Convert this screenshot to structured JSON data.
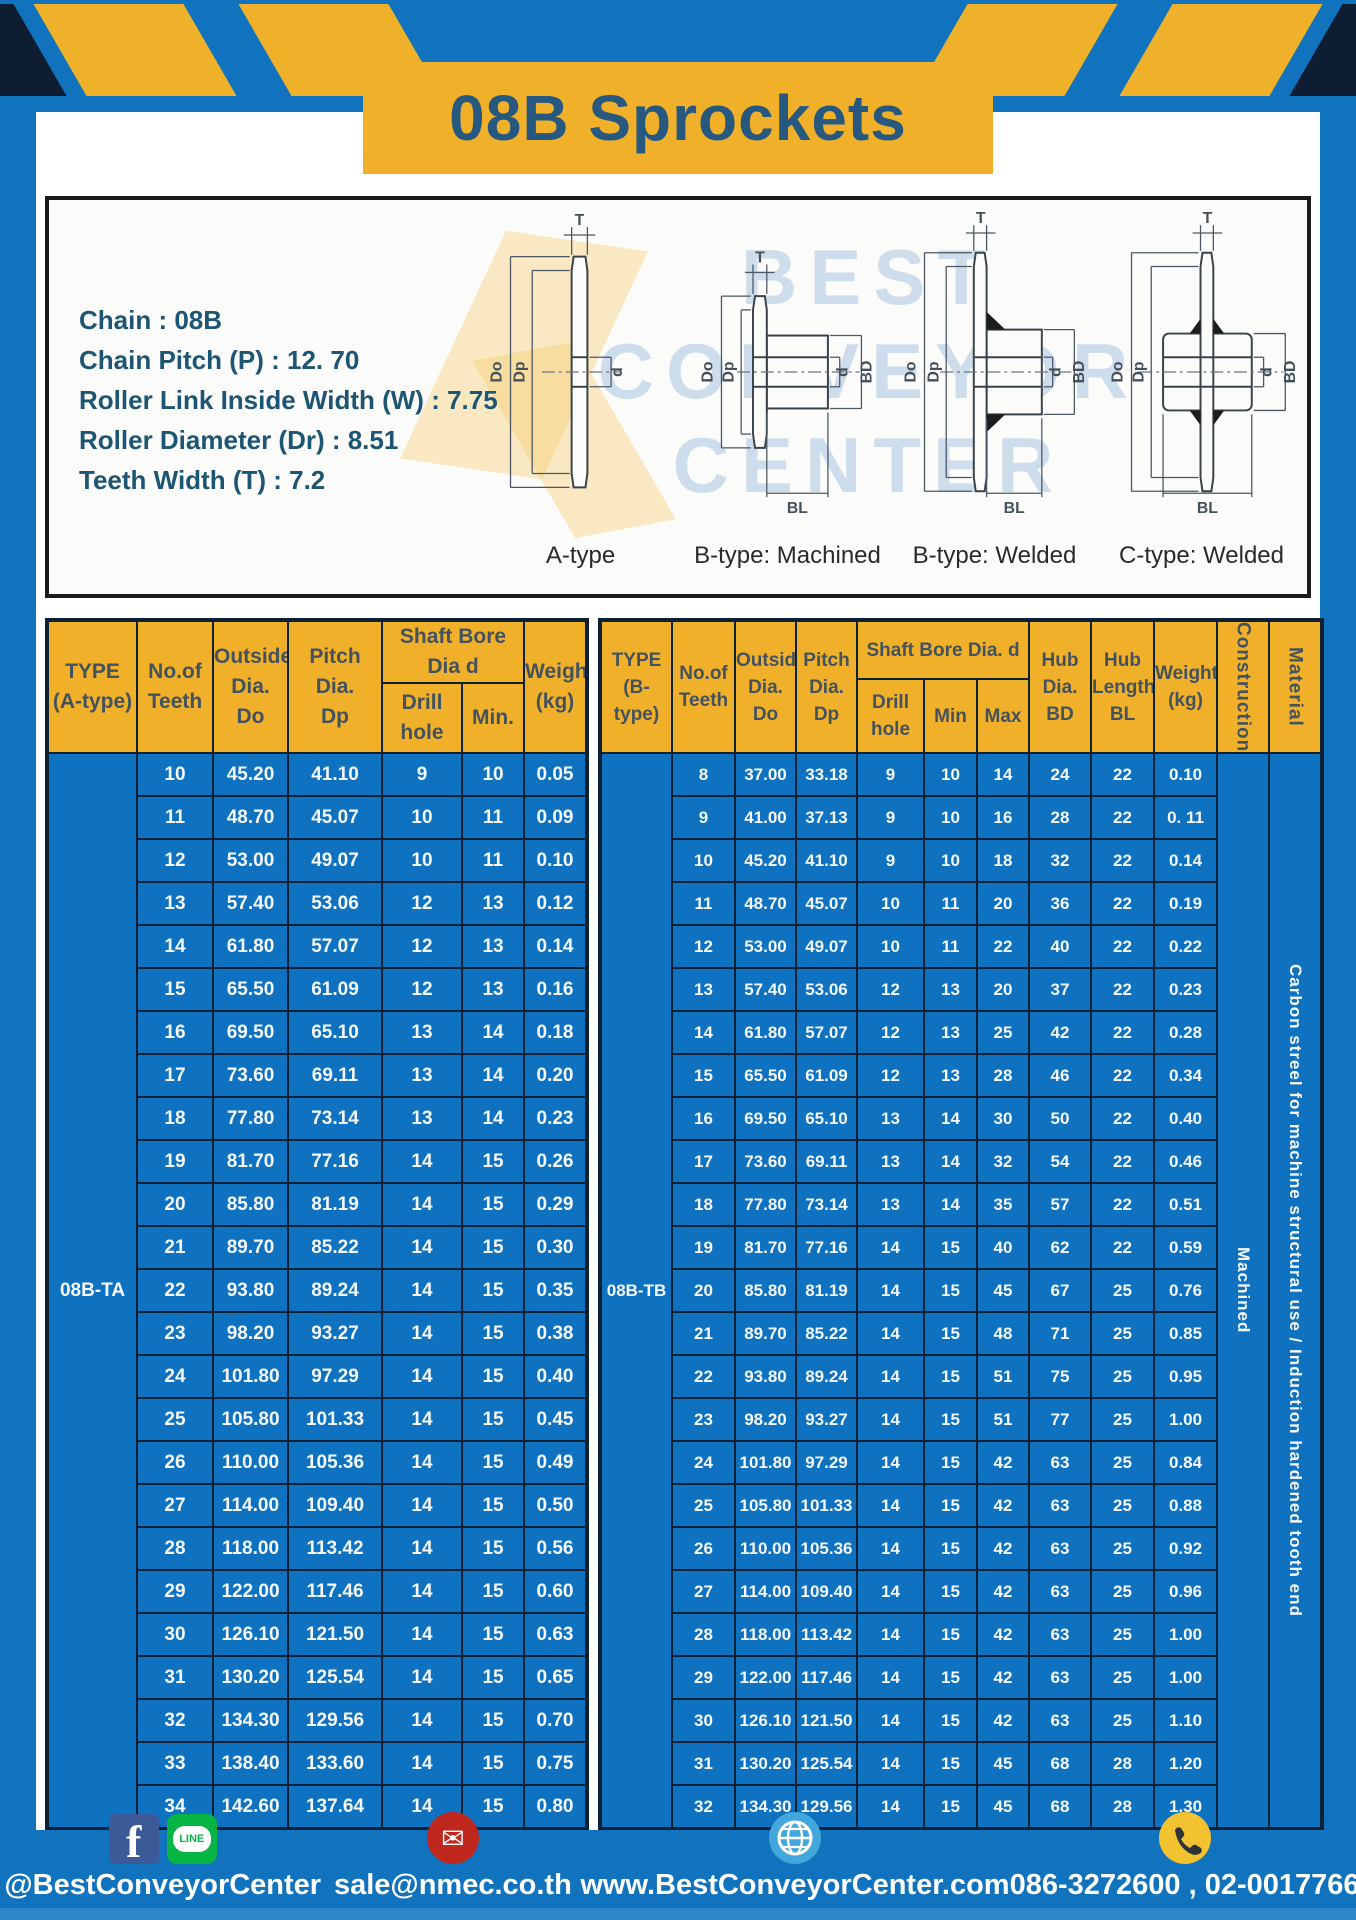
{
  "title": "08B Sprockets",
  "specs": {
    "lines": [
      "Chain  : 08B",
      "Chain Pitch (P)  :  12. 70",
      "Roller Link Inside Width (W)  :  7.75",
      "Roller Diameter (Dr)  : 8.51",
      "Teeth Width (T)  :  7.2"
    ]
  },
  "diagrams": {
    "captions": [
      "A-type",
      "B-type: Machined",
      "B-type: Welded",
      "C-type: Welded"
    ],
    "dims": {
      "t": "T",
      "do": "Do",
      "dp": "Dp",
      "d": "d",
      "bd": "BD",
      "bl": "BL"
    },
    "watermark": [
      "BEST",
      "CONVEYOR",
      "CENTER"
    ]
  },
  "table_a": {
    "type_label": "08B-TA",
    "headers": {
      "type1": "TYPE",
      "type2": "(A-type)",
      "teeth1": "No.of",
      "teeth2": "Teeth",
      "out1": "Outside",
      "out2": "Dia.",
      "out3": "Do",
      "pitch1": "Pitch Dia.",
      "pitch2": "Dp",
      "bore": "Shaft Bore Dia d",
      "drill": "Drill hole",
      "min": "Min.",
      "w1": "Weight",
      "w2": "(kg)"
    },
    "rows": [
      [
        "10",
        "45.20",
        "41.10",
        "9",
        "10",
        "0.05"
      ],
      [
        "11",
        "48.70",
        "45.07",
        "10",
        "11",
        "0.09"
      ],
      [
        "12",
        "53.00",
        "49.07",
        "10",
        "11",
        "0.10"
      ],
      [
        "13",
        "57.40",
        "53.06",
        "12",
        "13",
        "0.12"
      ],
      [
        "14",
        "61.80",
        "57.07",
        "12",
        "13",
        "0.14"
      ],
      [
        "15",
        "65.50",
        "61.09",
        "12",
        "13",
        "0.16"
      ],
      [
        "16",
        "69.50",
        "65.10",
        "13",
        "14",
        "0.18"
      ],
      [
        "17",
        "73.60",
        "69.11",
        "13",
        "14",
        "0.20"
      ],
      [
        "18",
        "77.80",
        "73.14",
        "13",
        "14",
        "0.23"
      ],
      [
        "19",
        "81.70",
        "77.16",
        "14",
        "15",
        "0.26"
      ],
      [
        "20",
        "85.80",
        "81.19",
        "14",
        "15",
        "0.29"
      ],
      [
        "21",
        "89.70",
        "85.22",
        "14",
        "15",
        "0.30"
      ],
      [
        "22",
        "93.80",
        "89.24",
        "14",
        "15",
        "0.35"
      ],
      [
        "23",
        "98.20",
        "93.27",
        "14",
        "15",
        "0.38"
      ],
      [
        "24",
        "101.80",
        "97.29",
        "14",
        "15",
        "0.40"
      ],
      [
        "25",
        "105.80",
        "101.33",
        "14",
        "15",
        "0.45"
      ],
      [
        "26",
        "110.00",
        "105.36",
        "14",
        "15",
        "0.49"
      ],
      [
        "27",
        "114.00",
        "109.40",
        "14",
        "15",
        "0.50"
      ],
      [
        "28",
        "118.00",
        "113.42",
        "14",
        "15",
        "0.56"
      ],
      [
        "29",
        "122.00",
        "117.46",
        "14",
        "15",
        "0.60"
      ],
      [
        "30",
        "126.10",
        "121.50",
        "14",
        "15",
        "0.63"
      ],
      [
        "31",
        "130.20",
        "125.54",
        "14",
        "15",
        "0.65"
      ],
      [
        "32",
        "134.30",
        "129.56",
        "14",
        "15",
        "0.70"
      ],
      [
        "33",
        "138.40",
        "133.60",
        "14",
        "15",
        "0.75"
      ],
      [
        "34",
        "142.60",
        "137.64",
        "14",
        "15",
        "0.80"
      ]
    ]
  },
  "table_b": {
    "type_label": "08B-TB",
    "construction": "Machined",
    "material": "Carbon streel for machine structural use / Induction hardened tooth end",
    "headers": {
      "type1": "TYPE",
      "type2": "(B-type)",
      "teeth1": "No.of",
      "teeth2": "Teeth",
      "out1": "Outside",
      "out2": "Dia.",
      "out3": "Do",
      "pitch1": "Pitch",
      "pitch2": "Dia.",
      "pitch3": "Dp",
      "bore": "Shaft Bore Dia.  d",
      "drill": "Drill hole",
      "min": "Min",
      "max": "Max",
      "hub1": "Hub",
      "hub2": "Dia.",
      "hub3": "BD",
      "hubl1": "Hub",
      "hubl2": "Length",
      "hubl3": "BL",
      "w1": "Weight",
      "w2": "(kg)",
      "construction": "Construction",
      "material": "Material"
    },
    "rows": [
      [
        "8",
        "37.00",
        "33.18",
        "9",
        "10",
        "14",
        "24",
        "22",
        "0.10"
      ],
      [
        "9",
        "41.00",
        "37.13",
        "9",
        "10",
        "16",
        "28",
        "22",
        "0. 11"
      ],
      [
        "10",
        "45.20",
        "41.10",
        "9",
        "10",
        "18",
        "32",
        "22",
        "0.14"
      ],
      [
        "11",
        "48.70",
        "45.07",
        "10",
        "11",
        "20",
        "36",
        "22",
        "0.19"
      ],
      [
        "12",
        "53.00",
        "49.07",
        "10",
        "11",
        "22",
        "40",
        "22",
        "0.22"
      ],
      [
        "13",
        "57.40",
        "53.06",
        "12",
        "13",
        "20",
        "37",
        "22",
        "0.23"
      ],
      [
        "14",
        "61.80",
        "57.07",
        "12",
        "13",
        "25",
        "42",
        "22",
        "0.28"
      ],
      [
        "15",
        "65.50",
        "61.09",
        "12",
        "13",
        "28",
        "46",
        "22",
        "0.34"
      ],
      [
        "16",
        "69.50",
        "65.10",
        "13",
        "14",
        "30",
        "50",
        "22",
        "0.40"
      ],
      [
        "17",
        "73.60",
        "69.11",
        "13",
        "14",
        "32",
        "54",
        "22",
        "0.46"
      ],
      [
        "18",
        "77.80",
        "73.14",
        "13",
        "14",
        "35",
        "57",
        "22",
        "0.51"
      ],
      [
        "19",
        "81.70",
        "77.16",
        "14",
        "15",
        "40",
        "62",
        "22",
        "0.59"
      ],
      [
        "20",
        "85.80",
        "81.19",
        "14",
        "15",
        "45",
        "67",
        "25",
        "0.76"
      ],
      [
        "21",
        "89.70",
        "85.22",
        "14",
        "15",
        "48",
        "71",
        "25",
        "0.85"
      ],
      [
        "22",
        "93.80",
        "89.24",
        "14",
        "15",
        "51",
        "75",
        "25",
        "0.95"
      ],
      [
        "23",
        "98.20",
        "93.27",
        "14",
        "15",
        "51",
        "77",
        "25",
        "1.00"
      ],
      [
        "24",
        "101.80",
        "97.29",
        "14",
        "15",
        "42",
        "63",
        "25",
        "0.84"
      ],
      [
        "25",
        "105.80",
        "101.33",
        "14",
        "15",
        "42",
        "63",
        "25",
        "0.88"
      ],
      [
        "26",
        "110.00",
        "105.36",
        "14",
        "15",
        "42",
        "63",
        "25",
        "0.92"
      ],
      [
        "27",
        "114.00",
        "109.40",
        "14",
        "15",
        "42",
        "63",
        "25",
        "0.96"
      ],
      [
        "28",
        "118.00",
        "113.42",
        "14",
        "15",
        "42",
        "63",
        "25",
        "1.00"
      ],
      [
        "29",
        "122.00",
        "117.46",
        "14",
        "15",
        "42",
        "63",
        "25",
        "1.00"
      ],
      [
        "30",
        "126.10",
        "121.50",
        "14",
        "15",
        "42",
        "63",
        "25",
        "1.10"
      ],
      [
        "31",
        "130.20",
        "125.54",
        "14",
        "15",
        "45",
        "68",
        "28",
        "1.20"
      ],
      [
        "32",
        "134.30",
        "129.56",
        "14",
        "15",
        "45",
        "68",
        "28",
        "1.30"
      ]
    ]
  },
  "footer": {
    "social": "@BestConveyorCenter",
    "email": "sale@nmec.co.th",
    "website": "www.BestConveyorCenter.com",
    "phone": "086-3272600 , 02-0017766",
    "facebook_letter": "f",
    "line_label": "LINE",
    "mail_glyph": "✉"
  },
  "colors": {
    "frame_blue": "#1173BD",
    "cell_blue": "#0F72C0",
    "accent_yellow": "#F0B02A",
    "border_dark": "#0D2134",
    "title_text": "#27587F",
    "header_text": "#44525E"
  }
}
